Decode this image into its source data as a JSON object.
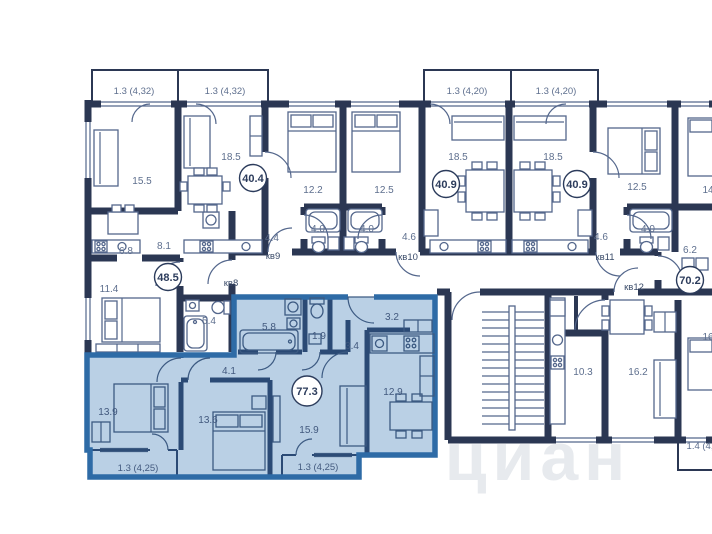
{
  "watermark": "циан",
  "colors": {
    "wall": "#2b3753",
    "thin": "#54678c",
    "label": "#5e6f8e",
    "flat_label": "#394a68",
    "badge_stroke": "#2c3c5c",
    "badge_text": "#2c3c5c",
    "selected_border": "#2e6ba6",
    "selected_fill": "#bad0e5",
    "selected_wall": "#2b4a75",
    "selected_label": "#42597e",
    "watermark_color": "#e7eaee",
    "background": "#ffffff"
  },
  "selected_apartment": {
    "total_area": "77.3",
    "room_areas": [
      "13.9",
      "13.6",
      "15.9",
      "12.9",
      "5.8",
      "1.9",
      "3.4",
      "3.2",
      "4.1"
    ],
    "balcony_areas": [
      "1.3 (4,25)",
      "1.3 (4,25)"
    ]
  },
  "badges": [
    {
      "value": "40.4",
      "x": 253,
      "y": 178,
      "r": 13.5
    },
    {
      "value": "40.9",
      "x": 446,
      "y": 184,
      "r": 13.5
    },
    {
      "value": "40.9",
      "x": 577,
      "y": 184,
      "r": 13.5
    },
    {
      "value": "48.5",
      "x": 168,
      "y": 277,
      "r": 13.5
    },
    {
      "value": "70.2",
      "x": 690,
      "y": 280,
      "r": 13.5
    },
    {
      "value": "77.3",
      "x": 307,
      "y": 391,
      "r": 15,
      "selected": true
    }
  ],
  "area_labels": [
    {
      "text": "1.3 (4,32)",
      "x": 134,
      "y": 91,
      "kind": "balcony"
    },
    {
      "text": "1.3 (4,32)",
      "x": 225,
      "y": 91,
      "kind": "balcony"
    },
    {
      "text": "1.3 (4,20)",
      "x": 467,
      "y": 91,
      "kind": "balcony"
    },
    {
      "text": "1.3 (4,20)",
      "x": 556,
      "y": 91,
      "kind": "balcony"
    },
    {
      "text": "15.5",
      "x": 142,
      "y": 181
    },
    {
      "text": "18.5",
      "x": 231,
      "y": 157
    },
    {
      "text": "12.2",
      "x": 313,
      "y": 190
    },
    {
      "text": "12.5",
      "x": 384,
      "y": 190
    },
    {
      "text": "18.5",
      "x": 458,
      "y": 157
    },
    {
      "text": "18.5",
      "x": 553,
      "y": 157
    },
    {
      "text": "12.5",
      "x": 637,
      "y": 187
    },
    {
      "text": "6.8",
      "x": 126,
      "y": 251
    },
    {
      "text": "8.1",
      "x": 164,
      "y": 246
    },
    {
      "text": "4.4",
      "x": 272,
      "y": 238
    },
    {
      "text": "4.0",
      "x": 318,
      "y": 229
    },
    {
      "text": "4.0",
      "x": 367,
      "y": 229
    },
    {
      "text": "4.6",
      "x": 409,
      "y": 237
    },
    {
      "text": "4.6",
      "x": 601,
      "y": 237
    },
    {
      "text": "4.0",
      "x": 648,
      "y": 229
    },
    {
      "text": "6.2",
      "x": 690,
      "y": 250
    },
    {
      "text": "11.4",
      "x": 109,
      "y": 289
    },
    {
      "text": "5.4",
      "x": 209,
      "y": 321
    },
    {
      "text": "10.3",
      "x": 583,
      "y": 372
    },
    {
      "text": "16.2",
      "x": 638,
      "y": 372
    },
    {
      "text": "14",
      "x": 708,
      "y": 190
    },
    {
      "text": "16",
      "x": 708,
      "y": 337
    },
    {
      "text": "1.4 (4,",
      "x": 700,
      "y": 446,
      "kind": "balcony"
    },
    {
      "text": "5.8",
      "x": 269,
      "y": 327,
      "kind": "selected"
    },
    {
      "text": "1.9",
      "x": 319,
      "y": 336,
      "kind": "selected"
    },
    {
      "text": "3.4",
      "x": 352,
      "y": 346,
      "kind": "selected"
    },
    {
      "text": "3.2",
      "x": 392,
      "y": 317,
      "kind": "selected"
    },
    {
      "text": "12.9",
      "x": 393,
      "y": 392,
      "kind": "selected"
    },
    {
      "text": "15.9",
      "x": 309,
      "y": 430,
      "kind": "selected"
    },
    {
      "text": "13.9",
      "x": 108,
      "y": 412,
      "kind": "selected"
    },
    {
      "text": "13.6",
      "x": 208,
      "y": 420,
      "kind": "selected"
    },
    {
      "text": "4.1",
      "x": 229,
      "y": 371,
      "kind": "selected"
    },
    {
      "text": "1.3 (4,25)",
      "x": 138,
      "y": 468,
      "kind": "selected-balcony"
    },
    {
      "text": "1.3 (4,25)",
      "x": 318,
      "y": 467,
      "kind": "selected-balcony"
    }
  ],
  "flat_labels": [
    {
      "text": "кв8",
      "x": 231,
      "y": 283
    },
    {
      "text": "кв9",
      "x": 273,
      "y": 256
    },
    {
      "text": "кв10",
      "x": 408,
      "y": 257
    },
    {
      "text": "кв11",
      "x": 605,
      "y": 257
    },
    {
      "text": "кв12",
      "x": 634,
      "y": 287
    }
  ]
}
